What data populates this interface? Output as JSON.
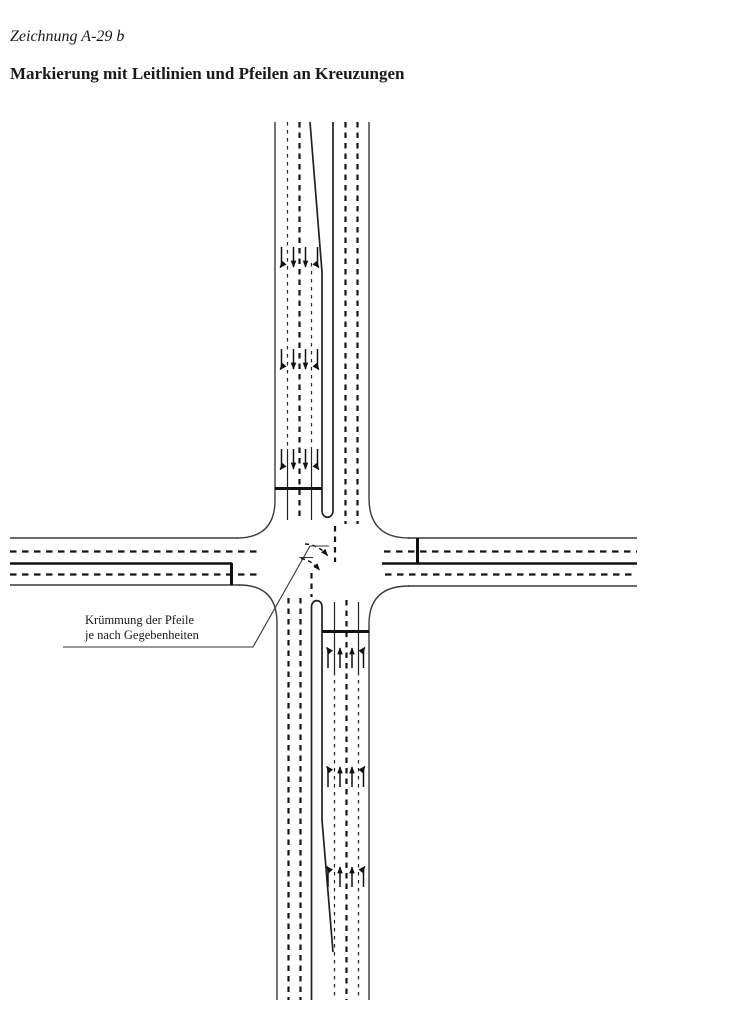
{
  "page": {
    "drawing_label": "Zeichnung A-29 b",
    "title": "Markierung mit Leitlinien und Pfeilen an Kreuzungen"
  },
  "annotation": {
    "line1": "Krümmung der Pfeile",
    "line2": "je nach Gegebenheiten"
  },
  "colors": {
    "ink": "#1a1a1a",
    "background": "#ffffff"
  }
}
